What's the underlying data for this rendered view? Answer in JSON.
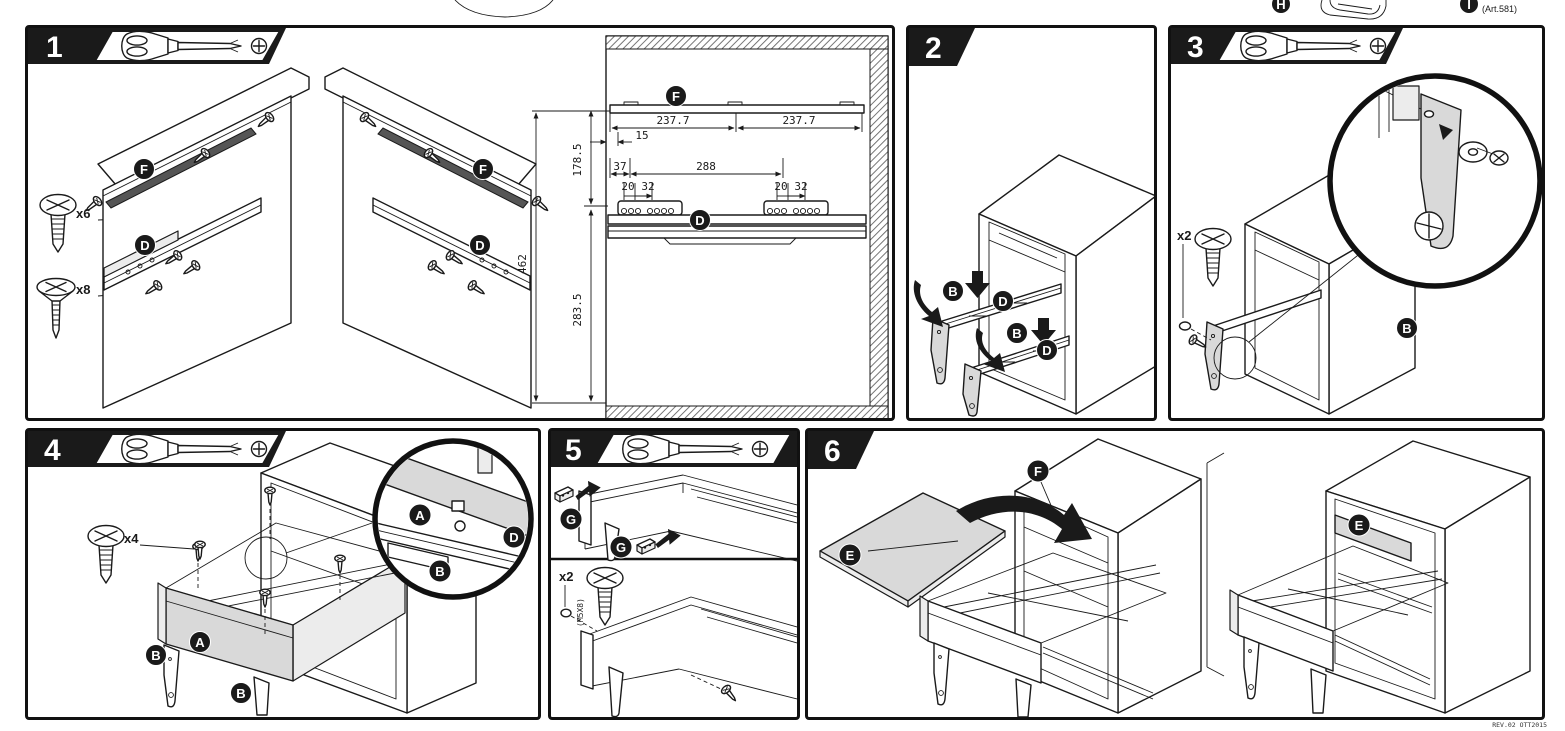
{
  "document": {
    "type": "assembly-instruction-sheet",
    "colors": {
      "ink": "#1a1a1a",
      "part_gray": "#d9d9d9",
      "paper": "#ffffff"
    }
  },
  "top_strip": {
    "h_label": "H",
    "i_label": "I",
    "art_number": "(Art.581)"
  },
  "tool": {
    "name": "phillips-screwdriver",
    "symbol": "phillips-cross"
  },
  "steps": {
    "s1": {
      "num": "1",
      "screw_pan_count": "x6",
      "screw_flat_count": "x8",
      "labels": {
        "f_left": "F",
        "d_left": "D",
        "f_right": "F",
        "d_right": "D",
        "f_dim": "F",
        "d_dim": "D"
      }
    },
    "s2": {
      "num": "2",
      "labels": {
        "b1": "B",
        "d1": "D",
        "b2": "B",
        "d2": "D"
      }
    },
    "s3": {
      "num": "3",
      "screw_count": "x2",
      "labels": {
        "b": "B"
      }
    },
    "s4": {
      "num": "4",
      "screw_count": "x4",
      "labels": {
        "a": "A",
        "b1": "B",
        "b2": "B",
        "zoom_a": "A",
        "zoom_b": "B",
        "zoom_d": "D"
      }
    },
    "s5": {
      "num": "5",
      "screw_count": "x2",
      "screw_spec": "(M5X8)",
      "labels": {
        "g1": "G",
        "g2": "G"
      }
    },
    "s6": {
      "num": "6",
      "labels": {
        "e": "E",
        "f": "F",
        "e_installed": "E"
      }
    }
  },
  "dimensions": {
    "rail_left": "237.7",
    "rail_right": "237.7",
    "edge_offset": "15",
    "rail_to_slide": "178.5",
    "front_offset": "37",
    "hole_span": "288",
    "hole_a1": "20",
    "hole_b1": "32",
    "hole_a2": "20",
    "hole_b2": "32",
    "total_height": "462",
    "slide_to_bottom": "283.5"
  },
  "footer": {
    "revision": "REV.02 OTT2015"
  }
}
